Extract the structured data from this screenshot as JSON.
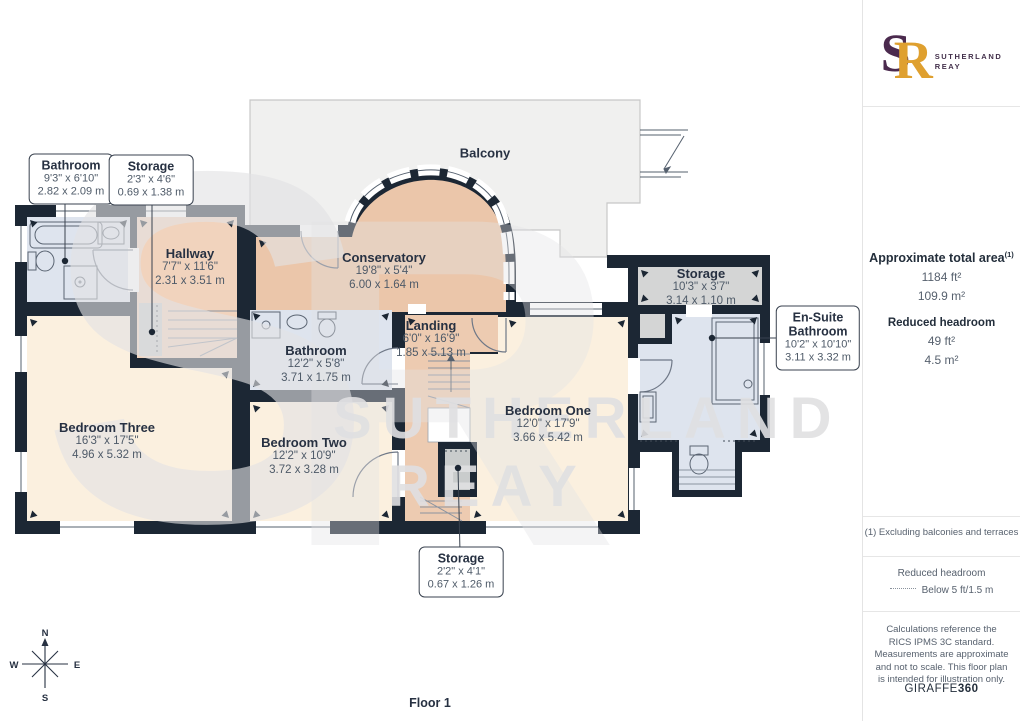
{
  "plan": {
    "floor_label": "Floor 1",
    "compass": {
      "n": "N",
      "s": "S",
      "e": "E",
      "w": "W"
    },
    "watermark": {
      "monogram_s": "S",
      "monogram_r": "R",
      "line1": "SUTHERLAND",
      "line2": "REAY"
    },
    "balcony": {
      "name": "Balcony"
    },
    "rooms": {
      "bathroom_tl": {
        "name": "Bathroom",
        "dims_ft": "9'3\" x 6'10\"",
        "dims_m": "2.82 x 2.09 m"
      },
      "storage_tl": {
        "name": "Storage",
        "dims_ft": "2'3\" x 4'6\"",
        "dims_m": "0.69 x 1.38 m"
      },
      "hallway": {
        "name": "Hallway",
        "dims_ft": "7'7\" x 11'6\"",
        "dims_m": "2.31 x 3.51 m"
      },
      "conservatory": {
        "name": "Conservatory",
        "dims_ft": "19'8\" x 5'4\"",
        "dims_m": "6.00 x 1.64 m"
      },
      "landing": {
        "name": "Landing",
        "dims_ft": "6'0\" x 16'9\"",
        "dims_m": "1.85 x 5.13 m"
      },
      "bathroom_mid": {
        "name": "Bathroom",
        "dims_ft": "12'2\" x 5'8\"",
        "dims_m": "3.71 x 1.75 m"
      },
      "bedroom_three": {
        "name": "Bedroom Three",
        "dims_ft": "16'3\" x 17'5\"",
        "dims_m": "4.96 x 5.32 m"
      },
      "bedroom_two": {
        "name": "Bedroom Two",
        "dims_ft": "12'2\" x 10'9\"",
        "dims_m": "3.72 x 3.28 m"
      },
      "bedroom_one": {
        "name": "Bedroom One",
        "dims_ft": "12'0\" x 17'9\"",
        "dims_m": "3.66 x 5.42 m"
      },
      "storage_tr": {
        "name": "Storage",
        "dims_ft": "10'3\" x 3'7\"",
        "dims_m": "3.14 x 1.10 m"
      },
      "ensuite": {
        "name_line1": "En-Suite",
        "name_line2": "Bathroom",
        "dims_ft": "10'2\" x 10'10\"",
        "dims_m": "3.11 x 3.32 m"
      },
      "storage_bottom": {
        "name": "Storage",
        "dims_ft": "2'2\" x 4'1\"",
        "dims_m": "0.67 x 1.26 m"
      }
    },
    "colors": {
      "wall": "#1c2734",
      "peach": "#edcbb1",
      "peach_dark": "#ebc6aa",
      "peach_light": "#f1d3bd",
      "cream": "#fbf0df",
      "bath": "#dee4ee",
      "storage": "#d4d5d5",
      "balcony": "#f0f0ef"
    }
  },
  "sidebar": {
    "logo": {
      "s": "S",
      "r": "R",
      "name_line1": "SUTHERLAND",
      "name_line2": "REAY"
    },
    "area": {
      "title": "Approximate total area",
      "sup": "(1)",
      "ft": "1184 ft²",
      "m": "109.9 m²"
    },
    "headroom": {
      "title": "Reduced headroom",
      "ft": "49 ft²",
      "m": "4.5 m²"
    },
    "footnote": "(1) Excluding balconies and terraces",
    "legend": {
      "title": "Reduced headroom",
      "label": "Below 5 ft/1.5 m"
    },
    "disclaimer": "Calculations reference the RICS IPMS 3C standard. Measurements are approximate and not to scale. This floor plan is intended for illustration only.",
    "brand": {
      "normal": "GIRAFFE",
      "bold": "360"
    }
  }
}
